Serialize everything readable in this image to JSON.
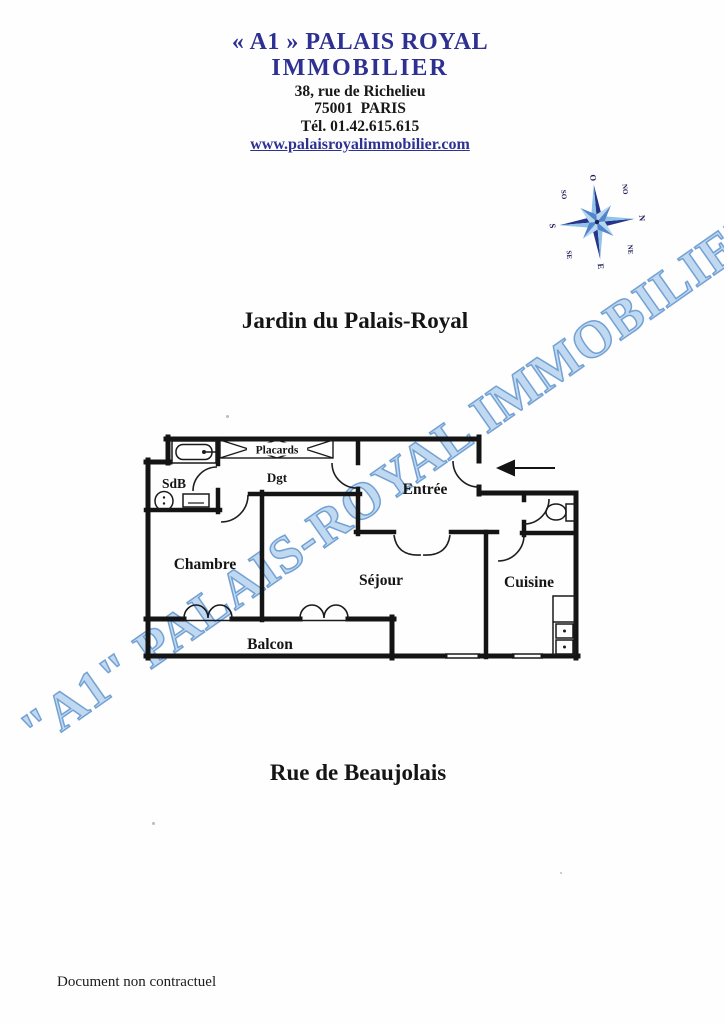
{
  "header": {
    "brand_line1": "« A1 » PALAIS ROYAL",
    "brand_line2": "IMMOBILIER",
    "address_line1": "38, rue de Richelieu",
    "address_line2": "75001  PARIS",
    "phone": "Tél. 01.42.615.615",
    "website": "www.palaisroyalimmobilier.com"
  },
  "streets": {
    "top": "Jardin du Palais-Royal",
    "bottom": "Rue de Beaujolais"
  },
  "watermark": {
    "text": "\"A1\" PALAIS-ROYAL IMMOBILIER"
  },
  "floor_plan": {
    "rooms": {
      "sdb": "SdB",
      "dgt": "Dgt",
      "placards": "Placards",
      "entree": "Entrée",
      "chambre": "Chambre",
      "sejour": "Séjour",
      "cuisine": "Cuisine",
      "balcon": "Balcon"
    }
  },
  "compass": {
    "n": "N",
    "ne": "NE",
    "e": "E",
    "se": "SE",
    "s": "S",
    "so": "SO",
    "o": "O",
    "no": "NO"
  },
  "footer": {
    "disclaimer": "Document non contractuel"
  },
  "colors": {
    "brand_blue": "#2e3192",
    "watermark_blue": "#82aede",
    "compass_dark": "#27348b",
    "compass_light": "#8fc3e8",
    "ink": "#141414"
  }
}
